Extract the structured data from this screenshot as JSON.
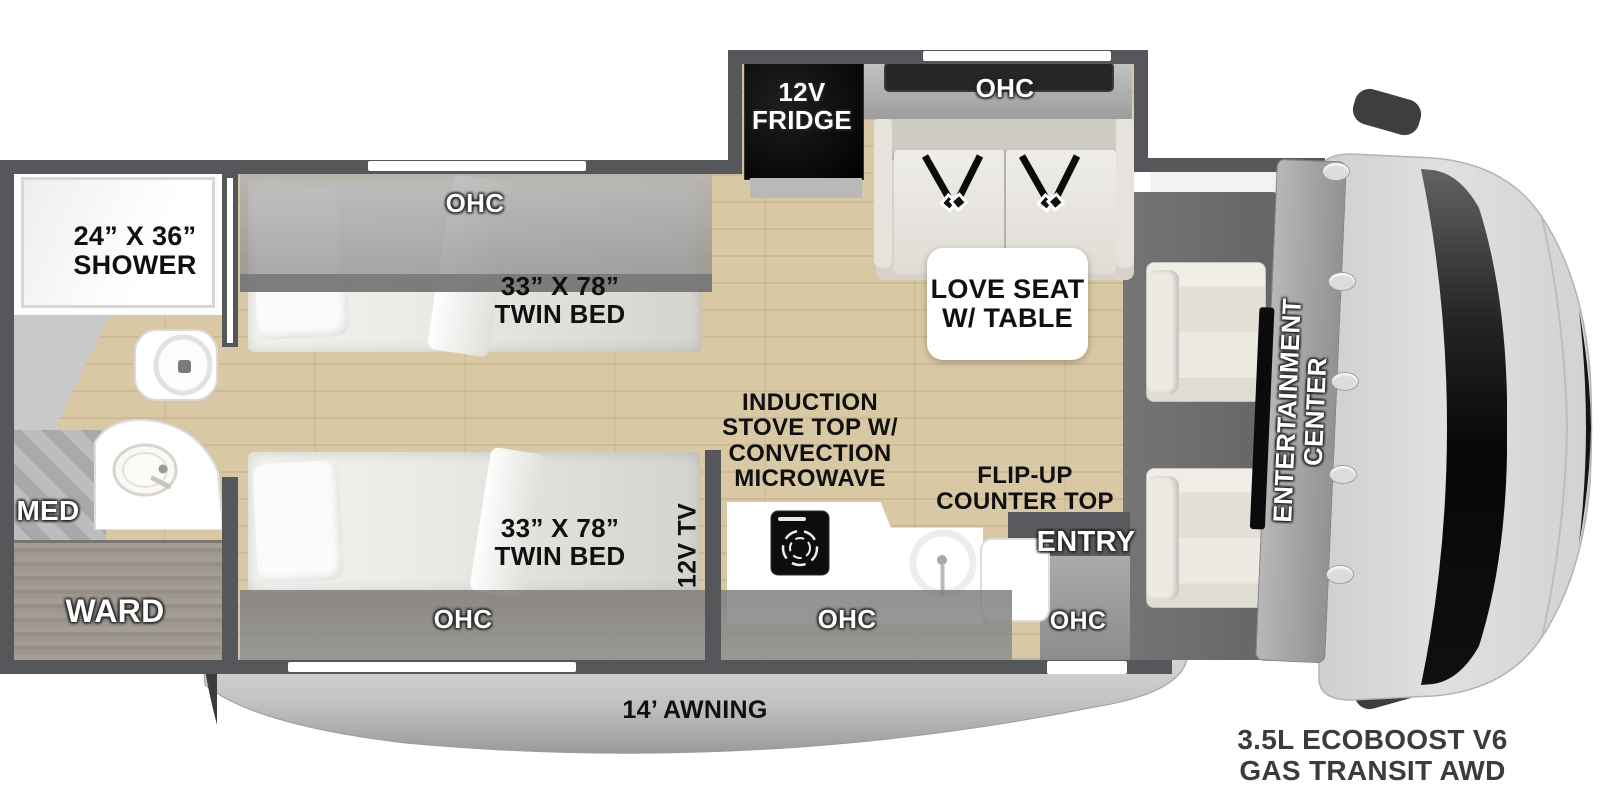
{
  "colors": {
    "wall": "#56575a",
    "floor_wood": "#d9c8a4",
    "cabinet_gray": "#9a948c",
    "appliance_black": "#0d0d0d",
    "mat_gray": "#6e6e6e",
    "awning_gray": "#bdbdbd",
    "label_black": "#101010",
    "label_white": "#ffffff"
  },
  "bathroom": {
    "shower_label": "24” X 36”\nSHOWER",
    "med_label": "MED",
    "ward_label": "WARD"
  },
  "bedroom": {
    "rear_ohc_label": "OHC",
    "rear_bed_label": "33” X 78”\nTWIN BED",
    "front_bed_label": "33” X 78”\nTWIN BED",
    "front_ohc_label": "OHC",
    "tv_label": "12V TV"
  },
  "galley": {
    "stove_label": "INDUCTION\nSTOVE TOP W/\nCONVECTION\nMICROWAVE",
    "flip_up_label": "FLIP-UP\nCOUNTER TOP",
    "ohc_label": "OHC",
    "entry_label": "ENTRY",
    "entry_ohc_label": "OHC"
  },
  "lounge": {
    "fridge_label": "12V\nFRIDGE",
    "ohc_label": "OHC",
    "love_seat_label": "LOVE SEAT\nW/ TABLE"
  },
  "cab": {
    "entertainment_label": "ENTERTAINMENT\nCENTER",
    "chassis_label": "3.5L ECOBOOST V6\nGAS TRANSIT AWD"
  },
  "exterior": {
    "awning_label": "14’ AWNING"
  }
}
